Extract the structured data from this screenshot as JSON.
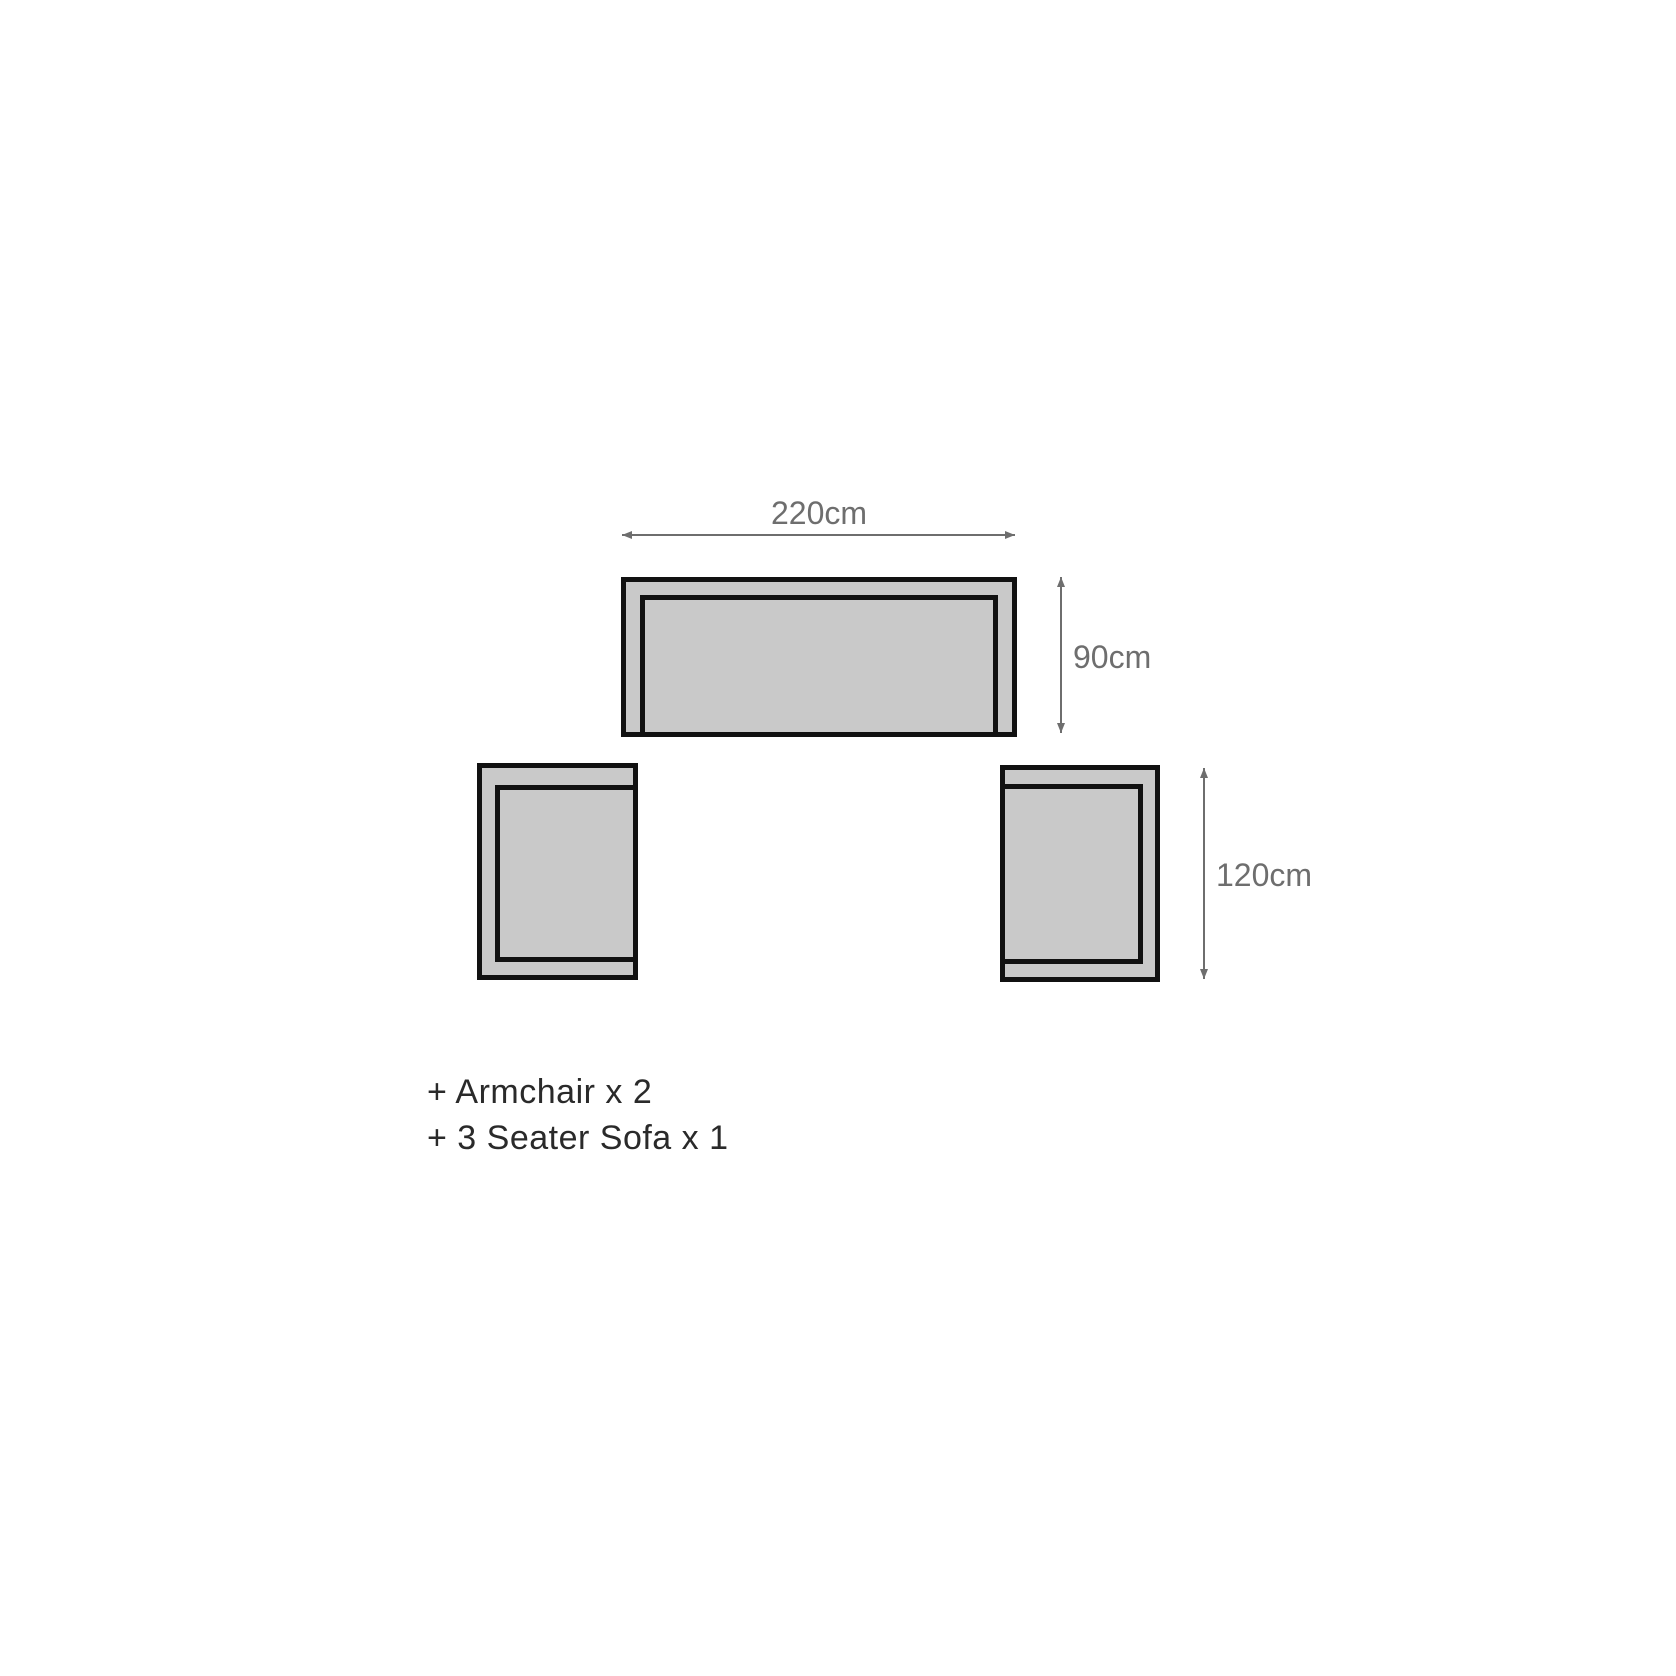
{
  "diagram": {
    "colors": {
      "background": "#ffffff",
      "furniture_fill": "#c9c9c9",
      "furniture_outline": "#111111",
      "dimension": "#6e6e6e",
      "legend_text": "#2a2a2a"
    },
    "dimensions": {
      "sofa_width_label": "220cm",
      "sofa_depth_label": "90cm",
      "armchair_depth_label": "120cm"
    },
    "legend": {
      "items": [
        "+ Armchair x 2",
        "+ 3 Seater Sofa x 1"
      ]
    }
  }
}
